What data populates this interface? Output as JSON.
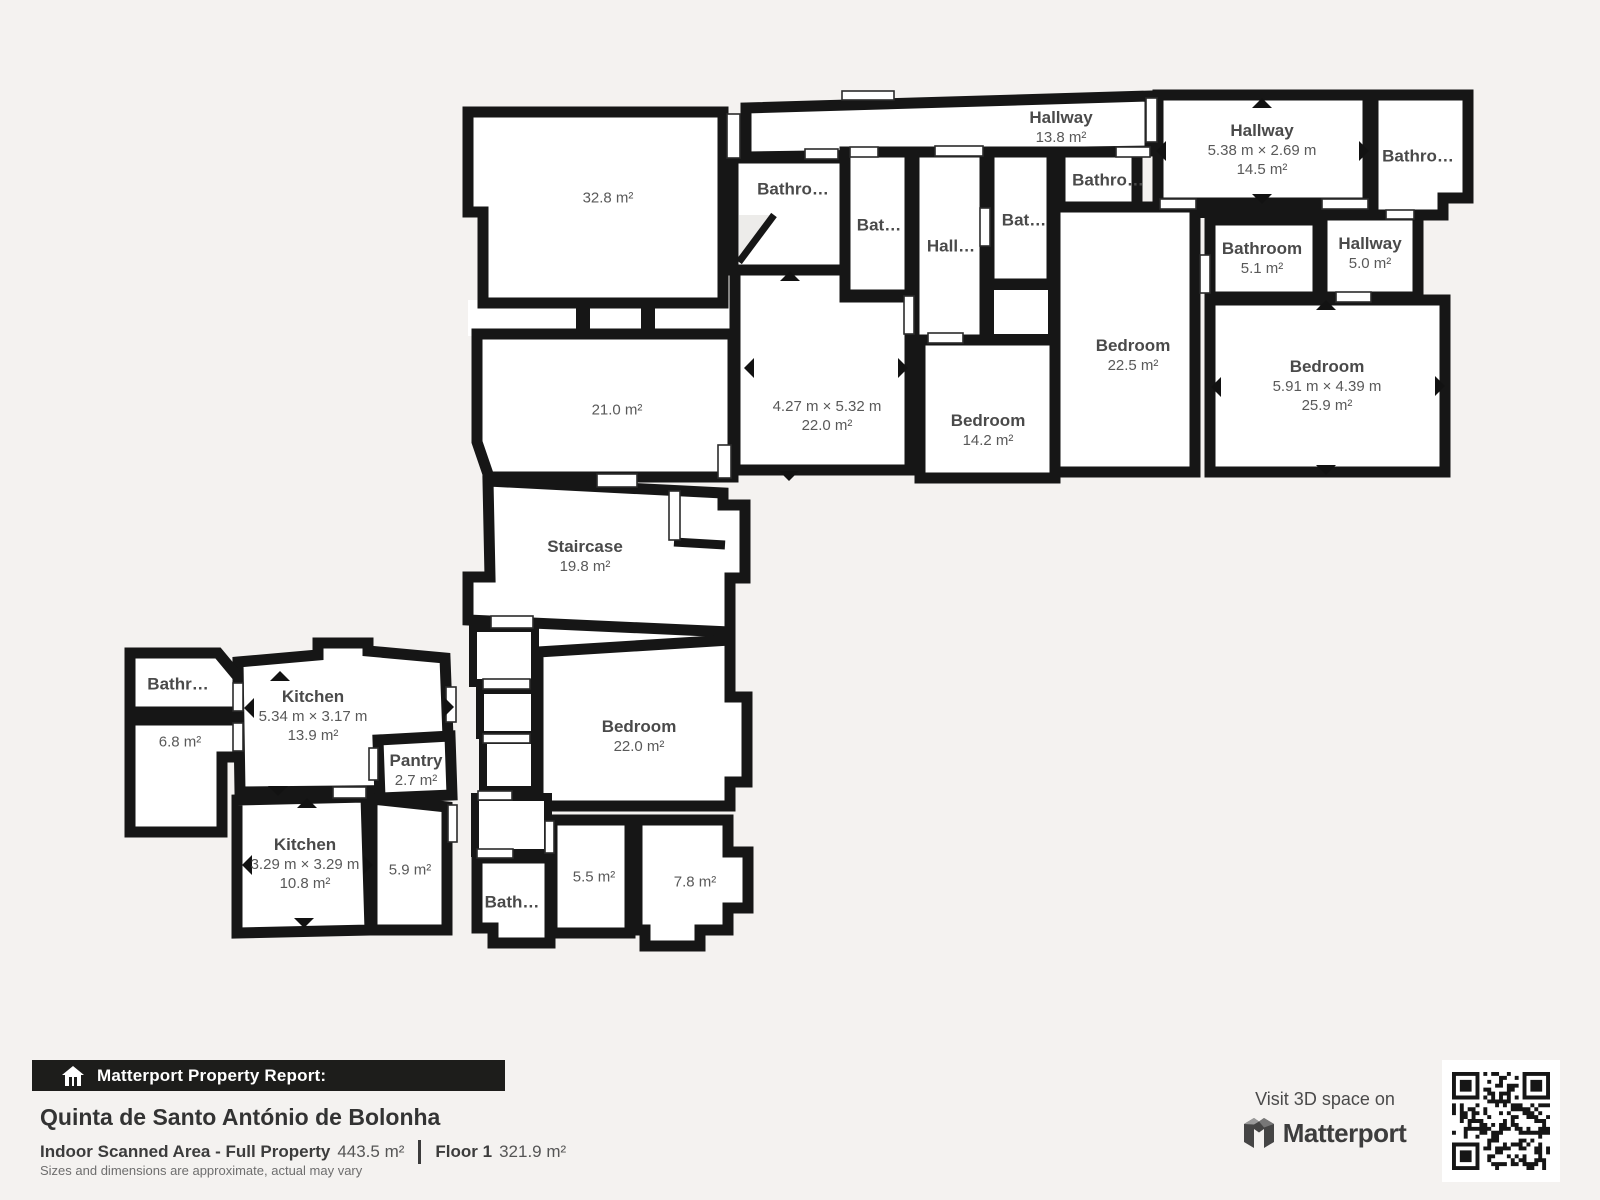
{
  "floorplan": {
    "rooms": [
      {
        "id": "hallway-top",
        "name": "Hallway",
        "area": "13.8 m²"
      },
      {
        "id": "bathroom-top-a",
        "name": "Bathro…"
      },
      {
        "id": "bathroom-top-b",
        "name": "Bat…"
      },
      {
        "id": "hallway-mid",
        "name": "Hall…"
      },
      {
        "id": "bathroom-top-c",
        "name": "Bat…"
      },
      {
        "id": "bathroom-top-d",
        "name": "Bathro…"
      },
      {
        "id": "hallway-right",
        "name": "Hallway",
        "dims": "5.38 m × 2.69 m",
        "area": "14.5 m²"
      },
      {
        "id": "bathroom-top-right",
        "name": "Bathro…"
      },
      {
        "id": "bathroom-right",
        "name": "Bathroom",
        "area": "5.1 m²"
      },
      {
        "id": "hallway-small-right",
        "name": "Hallway",
        "area": "5.0 m²"
      },
      {
        "id": "bedroom-center",
        "name": "Bedroom",
        "area": "22.5 m²"
      },
      {
        "id": "room-unnamed-top",
        "dims": "4.27 m × 5.32 m",
        "area": "22.0 m²"
      },
      {
        "id": "bedroom-mid",
        "name": "Bedroom",
        "area": "14.2 m²"
      },
      {
        "id": "bedroom-right",
        "name": "Bedroom",
        "dims": "5.91 m × 4.39 m",
        "area": "25.9 m²"
      },
      {
        "id": "room-32-8",
        "area": "32.8 m²"
      },
      {
        "id": "room-21-0",
        "area": "21.0 m²"
      },
      {
        "id": "staircase",
        "name": "Staircase",
        "area": "19.8 m²"
      },
      {
        "id": "bedroom-lower",
        "name": "Bedroom",
        "area": "22.0 m²"
      },
      {
        "id": "kitchen-upper",
        "name": "Kitchen",
        "dims": "5.34 m × 3.17 m",
        "area": "13.9 m²"
      },
      {
        "id": "pantry",
        "name": "Pantry",
        "area": "2.7 m²"
      },
      {
        "id": "bathroom-left",
        "name": "Bathr…"
      },
      {
        "id": "room-6-8",
        "area": "6.8 m²"
      },
      {
        "id": "kitchen-lower",
        "name": "Kitchen",
        "dims": "3.29 m × 3.29 m",
        "area": "10.8 m²"
      },
      {
        "id": "room-5-9",
        "area": "5.9 m²"
      },
      {
        "id": "bathroom-lower",
        "name": "Bath…"
      },
      {
        "id": "room-5-5",
        "area": "5.5 m²"
      },
      {
        "id": "room-7-8",
        "area": "7.8 m²"
      }
    ],
    "icons": {
      "arrow-up-icon": "▲",
      "arrow-down-icon": "▼",
      "arrow-left-icon": "◀",
      "arrow-right-icon": "▶"
    }
  },
  "footer": {
    "report_bar": {
      "icon": "house-icon",
      "label": "Matterport Property Report:"
    },
    "property_name": "Quinta de Santo António de Bolonha",
    "area_label": "Indoor Scanned Area - Full Property",
    "area_value": "443.5 m²",
    "floor_label": "Floor 1",
    "floor_value": "321.9 m²",
    "disclaimer": "Sizes and dimensions are approximate, actual may vary"
  },
  "cta": {
    "text": "Visit 3D space on",
    "brand": "Matterport",
    "icon": "matterport-logo",
    "qr": "qr-code"
  },
  "colors": {
    "background": "#f4f2f0",
    "wall": "#161616",
    "room_fill": "#ffffff",
    "label_text": "#4e4e4e",
    "footer_bar_bg": "#1d1d1b",
    "footer_bar_text": "#ffffff",
    "title_text": "#333333",
    "brand_text": "#3d3d3d",
    "disclaimer_text": "#6e6e6e"
  }
}
